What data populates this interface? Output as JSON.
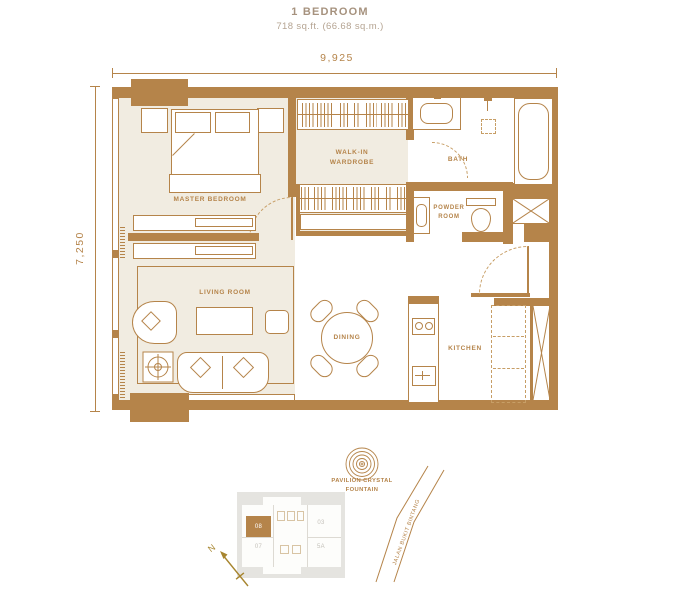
{
  "title": {
    "name": "1 BEDROOM",
    "area": "718 sq.ft. (66.68 sq.m.)"
  },
  "dimensions": {
    "width_label": "9,925",
    "height_label": "7,250"
  },
  "room_labels": {
    "master_bedroom": "MASTER BEDROOM",
    "walk_in_wardrobe": "WALK-IN WARDROBE",
    "bath": "BATH",
    "powder_room": "POWDER ROOM",
    "living_room": "LIVING ROOM",
    "dining": "DINING",
    "kitchen": "KITCHEN"
  },
  "site": {
    "fountain_label": "PAVILION CRYSTAL FOUNTAIN",
    "road_label": "JALAN BUKIT BINTANG",
    "north_label": "N",
    "key_plan_units": [
      {
        "id": "08",
        "highlighted": true
      },
      {
        "id": "07",
        "highlighted": false
      },
      {
        "id": "03",
        "highlighted": false
      },
      {
        "id": "5A",
        "highlighted": false
      }
    ]
  },
  "colors": {
    "wall_gold": "#B5844A",
    "floor_beige": "#F1ECE1",
    "title_brown": "#A6927E",
    "keyplan_gray": "#E5E4E0",
    "north_gold": "#A7852F"
  }
}
